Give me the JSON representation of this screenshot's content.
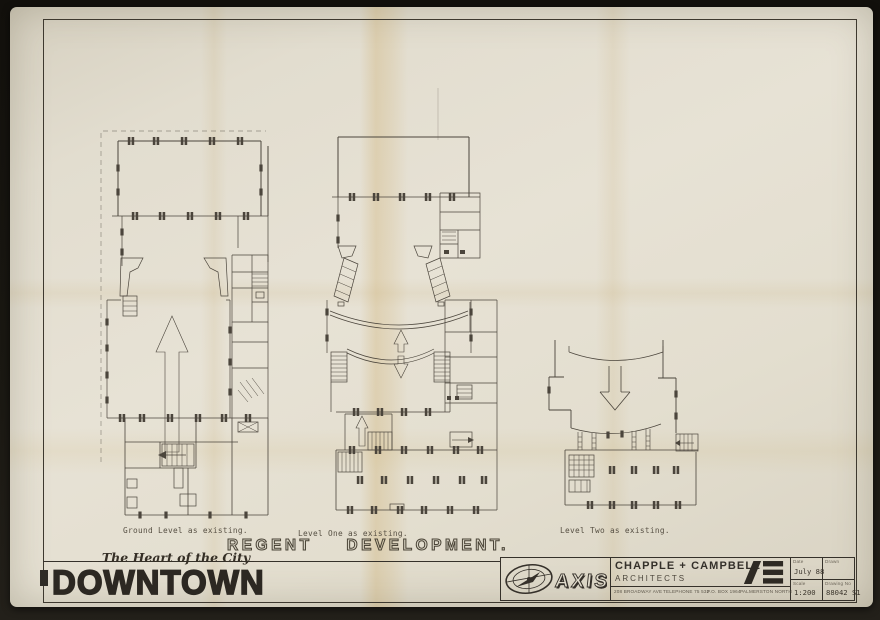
{
  "document": {
    "project_title": "REGENT  DEVELOPMENT.",
    "plans": [
      {
        "label": "Ground Level as existing."
      },
      {
        "label": "Level One as existing."
      },
      {
        "label": "Level Two as existing."
      }
    ],
    "branding": {
      "tagline": "The Heart of the City",
      "wordmark": "DOWNTOWN"
    },
    "title_block": {
      "logo_text": "AXIS",
      "firm_name": "CHAPPLE + CAMPBELL",
      "firm_role": "ARCHITECTS",
      "address_line": "208 BROADWAY AVE",
      "telephone": "TELEPHONE 75 532",
      "po_box": "P.O. BOX 1964",
      "city": "PALMERSTON NORTH",
      "date_label": "Date",
      "date_value": "July 88",
      "drawn_label": "Drawn",
      "drawn_value": "",
      "scale_label": "Scale",
      "scale_value": "1:200",
      "drawing_no_label": "Drawing No",
      "drawing_no_value": "88042 S1"
    }
  },
  "colors": {
    "paper": "#e3ded0",
    "ink": "#4b453c",
    "heavy_ink": "#2c2822",
    "background": "#15130e",
    "stain": "#c8a55f"
  }
}
